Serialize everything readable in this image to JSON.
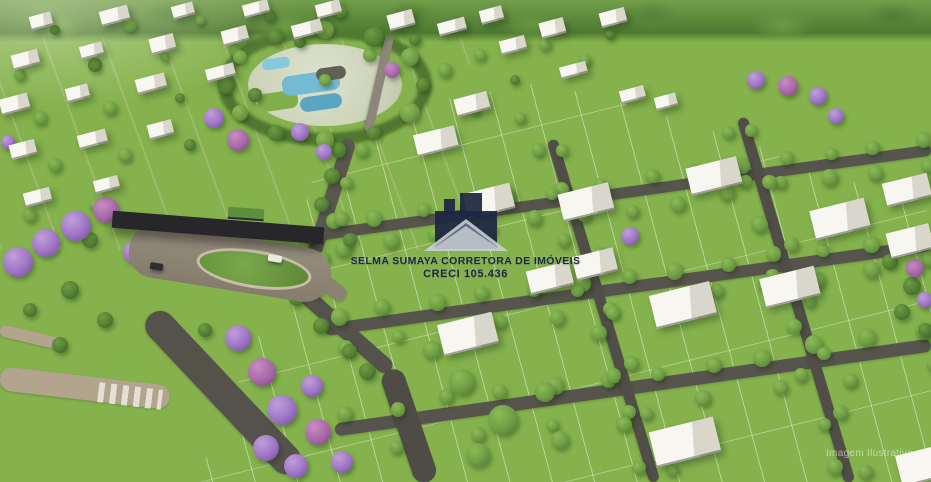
{
  "watermark": {
    "line1": "SELMA SUMAYA CORRETORA DE IMÓVEIS",
    "line2": "CRECI 105.436",
    "logo": "house-roof-logo",
    "text_color": "#1d2742"
  },
  "corner_note": "Imagem Ilustrativa",
  "colors": {
    "grass_green": "#85b24d",
    "forest_green": "#4b7530",
    "lot_line_white": "#ffffff",
    "road_asphalt": "#56534c",
    "road_sand": "#b3a48d",
    "house_white": "#f6f5f0",
    "pool_blue": "#6fb7d0",
    "jacaranda_purple": "#9d74c4",
    "gate_roof_dark": "#27262a",
    "watermark_navy": "#1d2742"
  }
}
